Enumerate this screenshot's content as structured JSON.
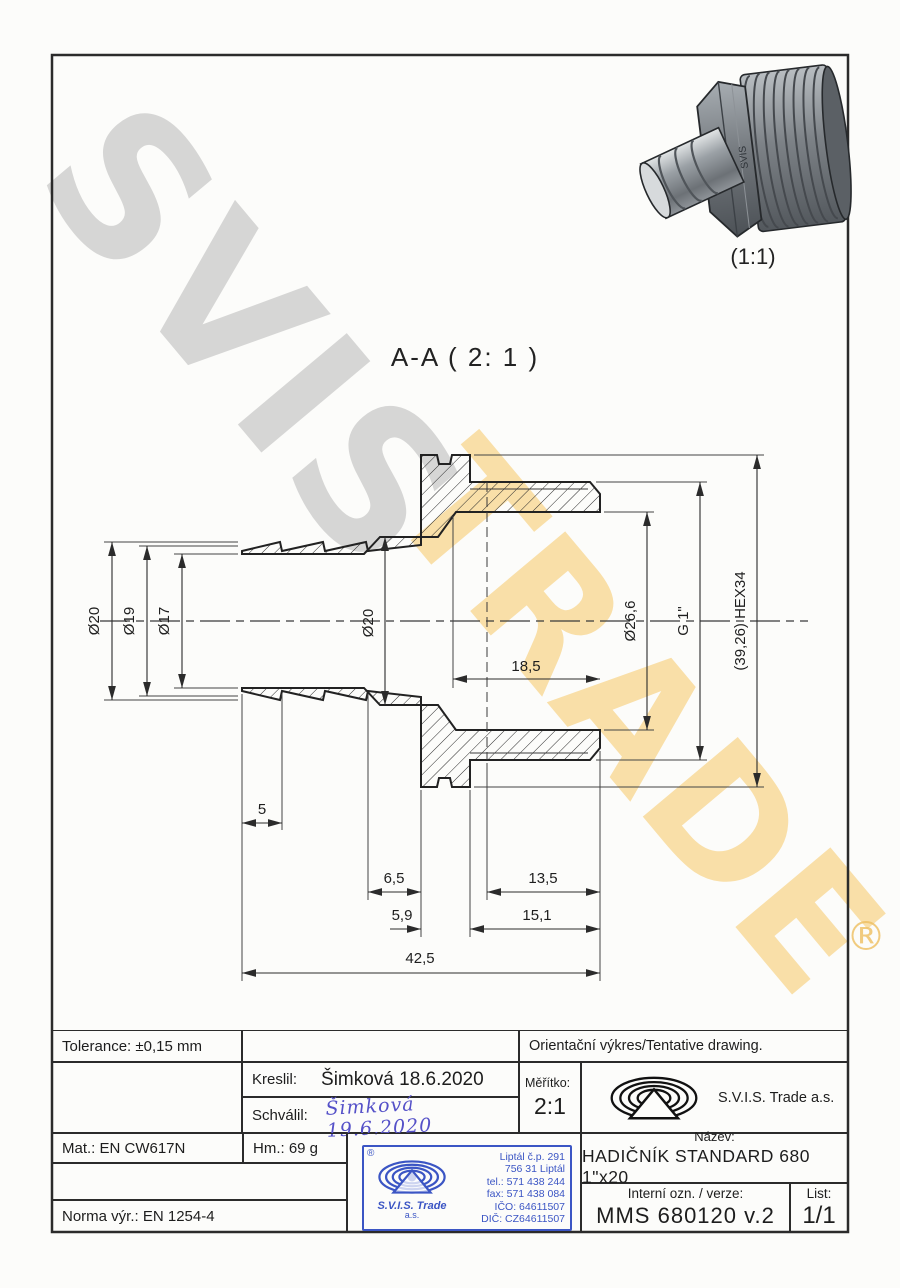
{
  "watermark": {
    "primary": "SVIS",
    "secondary": "TRADE",
    "registered": "®"
  },
  "view": {
    "section_label": "A-A ( 2: 1 )",
    "thumb_scale": "(1:1)",
    "thumb_brand": "SVIS"
  },
  "dims": {
    "dia_outer": "Ø20",
    "dia_mid": "Ø19",
    "dia_bore_small": "Ø17",
    "dia_bore": "Ø20",
    "dia_thread_bore": "Ø26,6",
    "thread": "G 1\"",
    "hex": "(39,26) HEX34",
    "bore_depth": "18,5",
    "barb_seg": "5",
    "neck": "6,5",
    "thread_len": "13,5",
    "hex_width": "5,9",
    "thread_total": "15,1",
    "overall": "42,5"
  },
  "titleblock": {
    "tolerance": "Tolerance: ±0,15 mm",
    "orientacni": "Orientační výkres/Tentative drawing.",
    "kreslil_label": "Kreslil:",
    "kreslil_value": "Šimková 18.6.2020",
    "schvalil_label": "Schválil:",
    "schvalil_value": "Šimková 19.6.2020",
    "meritko_label": "Měřítko:",
    "meritko_value": "2:1",
    "company": "S.V.I.S. Trade a.s.",
    "mat": "Mat.: EN CW617N",
    "hm": "Hm.: 69 g",
    "norma": "Norma výr.: EN 1254-4",
    "nazev_label": "Název:",
    "nazev_value": "HADIČNÍK STANDARD 680 1\"x20",
    "interni_label": "Interní ozn. / verze:",
    "interni_value": "MMS 680120 v.2",
    "list_label": "List:",
    "list_value": "1/1"
  },
  "stamp": {
    "registered": "®",
    "company": "S.V.I.S. Trade",
    "suffix": "a.s.",
    "address1": "Liptál č.p. 291",
    "address2": "756 31 Liptál",
    "phone": "tel.: 571 438 244",
    "fax": "fax: 571 438 084",
    "ico": "IČO: 64611507",
    "dic": "DIČ: CZ64611507"
  },
  "colors": {
    "line": "#2b2b2b",
    "stamp_blue": "#3b55c4",
    "watermark_gray": "#a8a8a8",
    "watermark_yellow": "#f5c664",
    "signature_blue": "#5551c8"
  }
}
